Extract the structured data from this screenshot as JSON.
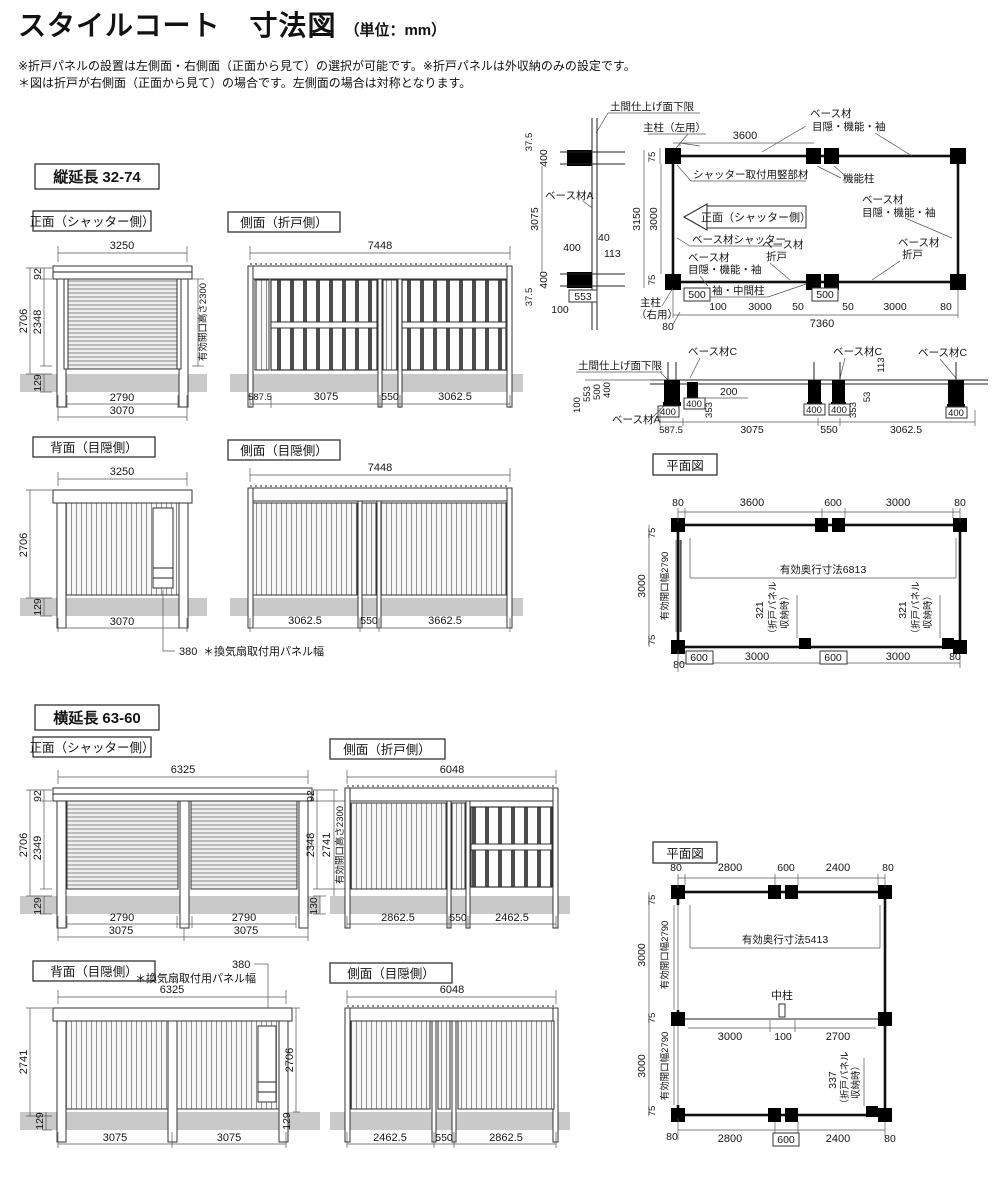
{
  "header": {
    "title": "スタイルコート　寸法図",
    "unit": "（単位：mm）",
    "note1": "※折戸パネルの設置は左側面・右側面（正面から見て）の選択が可能です。※折戸パネルは外収納のみの設定です。",
    "note2": "＊図は折戸が右側面（正面から見て）の場合です。左側面の場合は対称となります。"
  },
  "s1": {
    "tag": "縦延長 32-74",
    "front": {
      "title": "正面（シャッター側）",
      "top": "3250",
      "left": [
        "92",
        "2706",
        "2348",
        "129"
      ],
      "right": "有効開口高さ2300",
      "bottom": [
        "2790",
        "3070"
      ]
    },
    "sideFold": {
      "title": "側面（折戸側）",
      "top": "7448",
      "bottom": [
        "587.5",
        "3075",
        "550",
        "3062.5"
      ]
    },
    "back": {
      "title": "背面（目隠側）",
      "top": "3250",
      "left": [
        "2706",
        "129"
      ],
      "bottom": "3070",
      "vent": "380",
      "vent_note": "＊換気扇取付用パネル幅"
    },
    "sideHide": {
      "title": "側面（目隠側）",
      "top": "7448",
      "bottom": [
        "3062.5",
        "550",
        "3662.5"
      ]
    }
  },
  "detailV": {
    "doma": "土間仕上げ面下限",
    "dims": [
      "37.5",
      "400",
      "3075",
      "400",
      "37.5"
    ],
    "baseA": "ベース材A",
    "d400": "400",
    "d40": "40",
    "d113": "113",
    "d553": "553",
    "d100": "100"
  },
  "planTR": {
    "pillarL": "主柱（左用）",
    "top": "3600",
    "baseHideA": "ベース材",
    "baseHideB": "目隠・機能・袖",
    "kinou": "機能柱",
    "left": [
      "75",
      "3150",
      "3000",
      "75"
    ],
    "shutterMember": "シャッター取付用竪部材",
    "frontArrow": "正面（シャッター側）",
    "baseShutter": "ベース材シャッター",
    "baseHide2A": "ベース材",
    "baseHide2B": "目隠・機能・袖",
    "baseFoldA": "ベース材",
    "baseFoldB": "折戸",
    "baseHide3A": "ベース材",
    "baseHide3B": "目隠・機能・袖",
    "baseFold2A": "ベース材",
    "baseFold2B": "折戸",
    "sode": "袖・中間柱",
    "pillarRA": "主柱",
    "pillarRB": "（右用）",
    "b80l": "80",
    "b500l": "500",
    "b100": "100",
    "b3000l": "3000",
    "b50l": "50",
    "b500m": "500",
    "b50r": "50",
    "b3000r": "3000",
    "b80r": "80",
    "total": "7360"
  },
  "detailBase": {
    "doma": "土間仕上げ面下限",
    "c1": "ベース材C",
    "c2": "ベース材C",
    "c3": "ベース材C",
    "baseA": "ベース材A",
    "s100": "100",
    "s553": "553",
    "s500": "500",
    "s400": "400",
    "b400a": "400",
    "b400b": "400",
    "b400c": "400",
    "b400d": "400",
    "b400e": "400",
    "d353a": "353",
    "d353b": "353",
    "d200": "200",
    "d53": "53",
    "d113": "113",
    "bottom": [
      "587.5",
      "3075",
      "550",
      "3062.5"
    ]
  },
  "planTop": {
    "title": "平面図",
    "top": [
      "80",
      "3600",
      "600",
      "3000",
      "80"
    ],
    "left": [
      "75",
      "3000",
      "75"
    ],
    "left80": "80",
    "effW": "有効開口幅2790",
    "depth": "有効奥行寸法6813",
    "fold": "321",
    "foldN1": "（折戸パネル",
    "foldN2": "収納時）",
    "fold2": "321",
    "fold2N1": "（折戸パネル",
    "fold2N2": "収納時）",
    "bottom": [
      "600",
      "3000",
      "600",
      "3000",
      "80"
    ]
  },
  "s2": {
    "tag": "横延長 63-60",
    "front": {
      "title": "正面（シャッター側）",
      "top": "6325",
      "left": [
        "92",
        "2706",
        "2349",
        "129"
      ],
      "right": [
        "92",
        "2348",
        "2741",
        "有効開口高さ2300",
        "130"
      ],
      "bottom": [
        "2790",
        "3075",
        "2790",
        "3075"
      ]
    },
    "sideFold": {
      "title": "側面（折戸側）",
      "top": "6048",
      "bottom": [
        "2862.5",
        "550",
        "2462.5"
      ]
    },
    "back": {
      "title": "背面（目隠側）",
      "vent": "380",
      "vent_note": "＊換気扇取付用パネル幅",
      "top": "6325",
      "left": [
        "2741",
        "129"
      ],
      "right": [
        "2706",
        "129"
      ],
      "bottom": [
        "3075",
        "3075"
      ]
    },
    "sideHide": {
      "title": "側面（目隠側）",
      "top": "6048",
      "bottom": [
        "2462.5",
        "550",
        "2862.5"
      ]
    }
  },
  "planBottom": {
    "title": "平面図",
    "top": [
      "80",
      "2800",
      "600",
      "2400",
      "80"
    ],
    "left": [
      "75",
      "3000",
      "75",
      "3000",
      "75"
    ],
    "effW1": "有効開口幅2790",
    "effW2": "有効開口幅2790",
    "left80": "80",
    "depth": "有効奥行寸法5413",
    "naka": "中柱",
    "mid": [
      "3000",
      "100",
      "2700"
    ],
    "fold": "337",
    "foldN1": "（折戸パネル",
    "foldN2": "収納時）",
    "bottom": [
      "2800",
      "600",
      "2400",
      "80"
    ]
  }
}
